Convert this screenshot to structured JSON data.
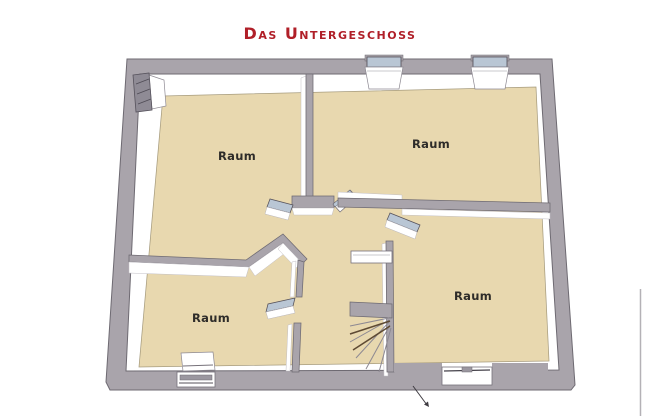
{
  "page": {
    "title": "Das Untergeschoss"
  },
  "floor_plan": {
    "rooms": [
      {
        "id": "top-left",
        "label": "Raum"
      },
      {
        "id": "top-right",
        "label": "Raum"
      },
      {
        "id": "bottom-right",
        "label": "Raum"
      },
      {
        "id": "bottom-left",
        "label": "Raum"
      }
    ]
  },
  "colors": {
    "title": "#b01f28",
    "floor": "#e8d8af",
    "wall": "#a9a4ab",
    "wall_outline": "#6e6a72",
    "glass": "#b9c6d4",
    "room_label": "#2e2c29"
  }
}
